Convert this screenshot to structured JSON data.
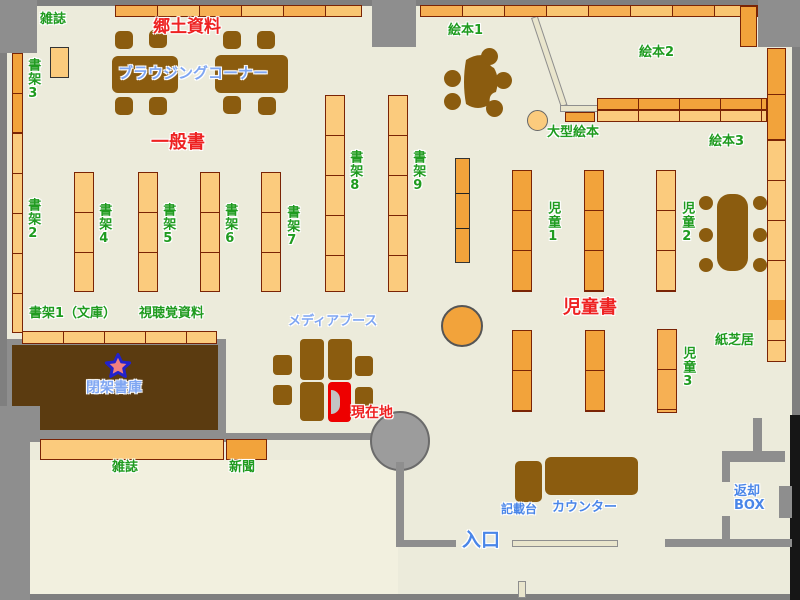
{
  "title": "図書館フロアマップ",
  "labels": {
    "zasshi_top": "雑誌",
    "kyodo_shiryo": "郷土資料",
    "browsing_corner": "ブラウジングコーナー",
    "shoka3": "書架3",
    "shoka2": "書架2",
    "ippansho": "一般書",
    "shoka4": "書架4",
    "shoka5": "書架5",
    "shoka6": "書架6",
    "shoka7": "書架7",
    "shoka8": "書架8",
    "shoka9": "書架9",
    "ehon1": "絵本1",
    "ehon2": "絵本2",
    "ehon3": "絵本3",
    "ogata_ehon": "大型絵本",
    "jido1": "児童1",
    "jido2": "児童2",
    "jido3": "児童3",
    "jidosho": "児童書",
    "kamishibai": "紙芝居",
    "shoka1_bunko": "書架1（文庫）",
    "shichokaku_shiryo": "視聴覚資料",
    "heika_shoko": "閉架書庫",
    "media_booth": "メディアブース",
    "genzaichi": "現在地",
    "zasshi_bottom": "雑誌",
    "shimbun": "新聞",
    "kisaidai": "記載台",
    "counter": "カウンター",
    "iriguchi": "入口",
    "henkyaku_line1": "返却",
    "henkyaku_line2": "BOX"
  },
  "colors": {
    "floor": "#ECEBDB",
    "wall_gray": "#8E8E8E",
    "shelf_light": "#FBCB7D",
    "shelf_dark": "#F2A33B",
    "shelf_border": "#7A2405",
    "furniture_brown": "#8B5C0F",
    "closed_stacks_brown": "#5B3B10",
    "label_green": "#1F9B1F",
    "label_red": "#EE2222",
    "label_blue": "#4A86E8",
    "current_location_red": "#EE0000"
  },
  "markers": {
    "closed_stacks_star": "star",
    "current_location_booth": "red-highlight"
  }
}
